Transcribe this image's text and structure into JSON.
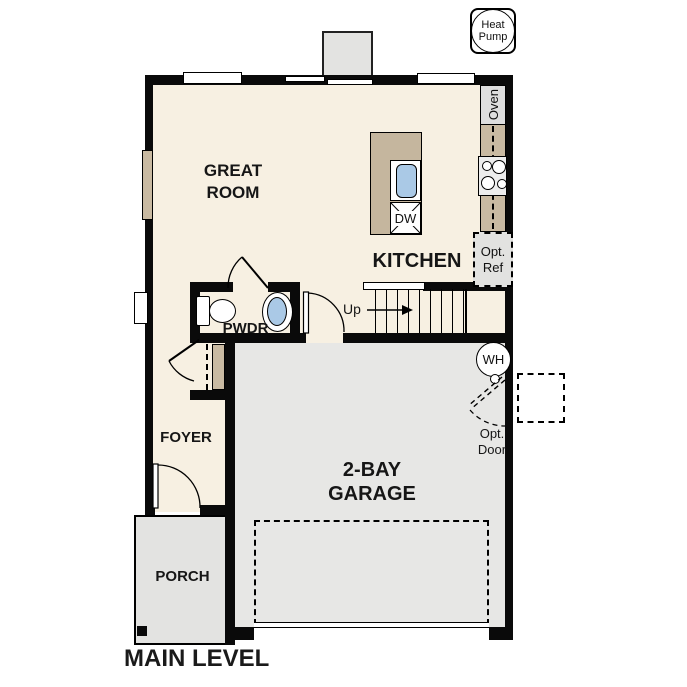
{
  "plan_title": "MAIN LEVEL",
  "badge": {
    "line1": "Heat",
    "line2": "Pump"
  },
  "rooms": {
    "great_room": {
      "line1": "GREAT",
      "line2": "ROOM"
    },
    "kitchen": {
      "label": "KITCHEN"
    },
    "pwdr": {
      "label": "PWDR"
    },
    "foyer": {
      "label": "FOYER"
    },
    "porch": {
      "label": "PORCH"
    },
    "garage": {
      "line1": "2-BAY",
      "line2": "GARAGE"
    }
  },
  "fixtures": {
    "oven": "Oven",
    "dishwasher": "DW",
    "opt_ref": {
      "line1": "Opt.",
      "line2": "Ref"
    },
    "water_heater": "WH",
    "opt_door": {
      "line1": "Opt.",
      "line2": "Door"
    },
    "stairs_direction": "Up"
  },
  "colors": {
    "floor": "#f7f0e2",
    "garage_floor": "#e7e7e5",
    "porch_floor": "#e3e3e1",
    "counter": "#c9baa2",
    "island": "#c5b69e",
    "sink_blue": "#aac9e6",
    "wall": "#0a0a0a",
    "appliance_gray": "#e5e5e5"
  }
}
